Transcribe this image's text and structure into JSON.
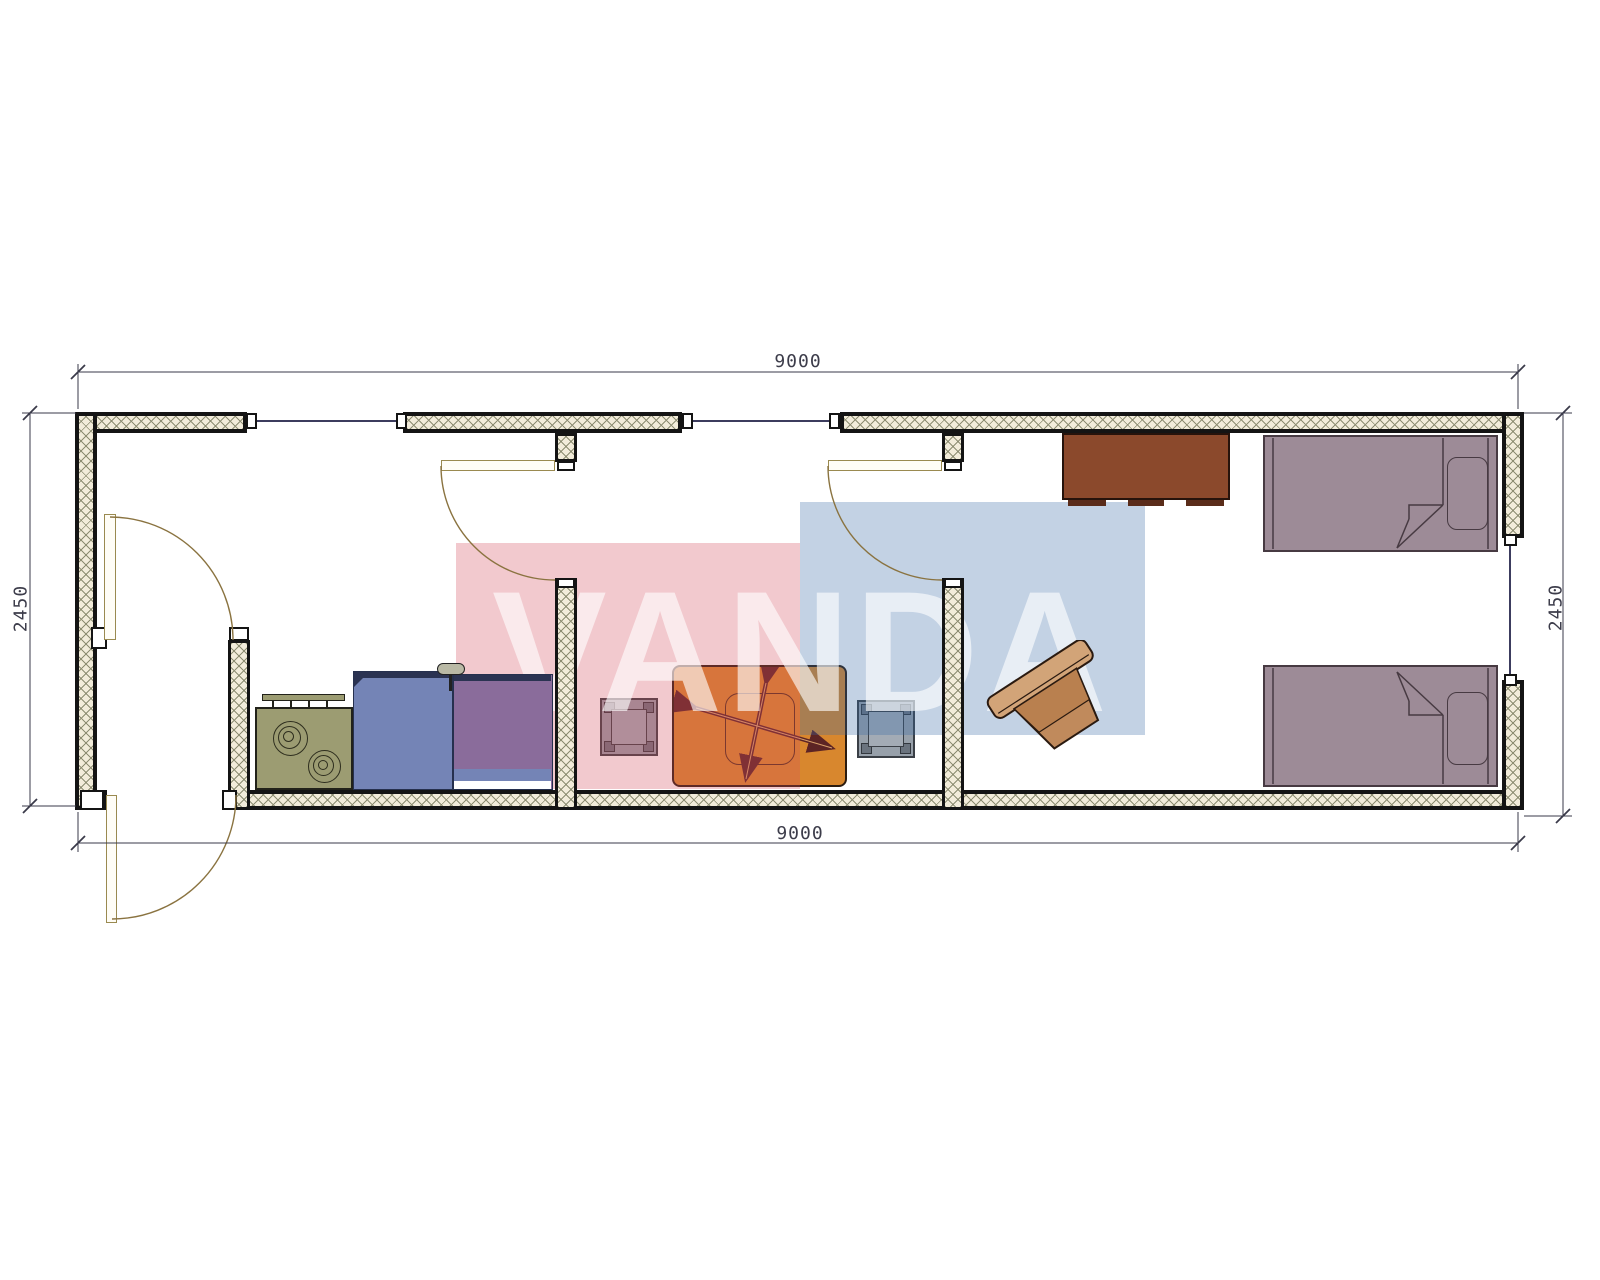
{
  "title": "Container house floor plan 9000 x 2450",
  "watermark": {
    "text": "VANDA",
    "pink_block": "#f2c9ce",
    "blue_block": "#c3d2e4"
  },
  "dimensions": {
    "top": "9000",
    "bottom": "9000",
    "left": "2450",
    "right": "2450"
  },
  "colors": {
    "wall_fill": "#f2ecda",
    "wall_hatch_line": "#8d8d72",
    "wall_edge": "#141414",
    "door": "#9a8a50",
    "dimension_line": "#3a3a4a",
    "stove": "#9c9c72",
    "kitchen_counter": "#7484b6",
    "sink_unit": "#8a6c9b",
    "dining_table": "#d8872e",
    "chair": "#97a0aa",
    "bed": "#9d8b97",
    "cabinet": "#8b492c",
    "desk_chair": "#c99a6a"
  },
  "rooms": {
    "left": "entry hall / kitchen",
    "middle": "dining room",
    "right": "bedroom"
  }
}
